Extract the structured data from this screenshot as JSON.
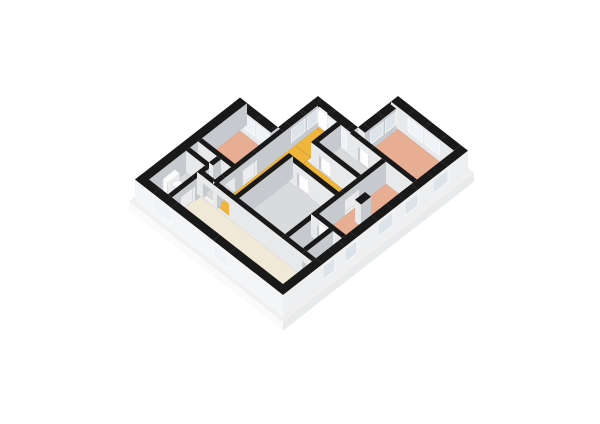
{
  "scene": {
    "proj": {
      "ox": 135,
      "oy": 201.5,
      "sl": 0.78,
      "wallH": 22
    },
    "colors": {
      "bg": "#ffffff",
      "wallTop": "#191919",
      "intS": "#e8e9eb",
      "intE": "#c6c9ce",
      "extS": "#f4f5f6",
      "extE": "#edeff1",
      "sillTop": "#dddfe2",
      "glassS": "#edf3f7",
      "glassE": "#dce4ea",
      "frame": "#ffffff",
      "leafS": "#fdfdfe",
      "leafE": "#ececee",
      "leafTop": "#f6f6f7",
      "plinthTop": "#f0f0f1",
      "plinthS": "#fafafb",
      "plinthE": "#e8eaec",
      "salmon": "#e7ae93",
      "yellow": "#f0b53c",
      "cream": "#f0e9d8",
      "gray": "#d8dadc",
      "bath": "#c3cfda",
      "toiletTop": "#fbfbfc",
      "toiletBody": "#e7e9eb",
      "floorEdge": "rgba(0,0,0,0.10)"
    },
    "plinth": {
      "top": [
        [
          -3,
          -3
        ],
        [
          151,
          -3
        ],
        [
          151,
          188
        ],
        [
          75,
          188
        ],
        [
          75,
          148
        ],
        [
          35,
          148
        ],
        [
          35,
          108
        ],
        [
          -3,
          108
        ]
      ],
      "h": 9
    },
    "floors": [
      {
        "name": "living-room",
        "r": [
          26,
          7,
          141,
          36
        ],
        "c": "cream"
      },
      {
        "name": "wc",
        "r": [
          7,
          7,
          26,
          44
        ],
        "c": "gray"
      },
      {
        "name": "corridor-west",
        "r": [
          7,
          44,
          40,
          56
        ],
        "c": "gray"
      },
      {
        "name": "storage",
        "r": [
          30,
          40,
          44,
          56
        ],
        "c": "gray"
      },
      {
        "name": "bedroom-top-left",
        "r": [
          7,
          60,
          40,
          98
        ],
        "c": "salmon"
      },
      {
        "name": "hall-main",
        "r": [
          44,
          38,
          60,
          116
        ],
        "c": "yellow"
      },
      {
        "name": "hall-entry",
        "r": [
          44,
          116,
          64,
          141
        ],
        "c": "yellow"
      },
      {
        "name": "hall-threshold",
        "r": [
          42,
          138,
          54,
          145
        ],
        "c": "yellow"
      },
      {
        "name": "corridor-east",
        "r": [
          60,
          94,
          110,
          112
        ],
        "c": "yellow"
      },
      {
        "name": "room-middle-south",
        "r": [
          64,
          42,
          110,
          90
        ],
        "c": "gray"
      },
      {
        "name": "room-middle-north",
        "r": [
          68,
          116,
          110,
          137
        ],
        "c": "gray"
      },
      {
        "name": "bathroom",
        "r": [
          114,
          42,
          128,
          66
        ],
        "c": "bath"
      },
      {
        "name": "closet",
        "r": [
          132,
          42,
          141,
          66
        ],
        "c": "gray"
      },
      {
        "name": "bedroom-bottom-right",
        "r": [
          114,
          70,
          141,
          137
        ],
        "c": "salmon"
      },
      {
        "name": "bedroom-top-right",
        "r": [
          85,
          141,
          141,
          178
        ],
        "c": "salmon"
      }
    ],
    "walls": [
      {
        "r": [
          0,
          0,
          7,
          105
        ],
        "t": "s"
      },
      {
        "r": [
          0,
          98,
          10,
          105
        ],
        "t": "s"
      },
      {
        "r": [
          10,
          98,
          22,
          105
        ],
        "t": "w"
      },
      {
        "r": [
          22,
          98,
          24,
          105
        ],
        "t": "s"
      },
      {
        "r": [
          24,
          98,
          36,
          105
        ],
        "t": "w"
      },
      {
        "r": [
          36,
          98,
          38,
          105
        ],
        "t": "s"
      },
      {
        "r": [
          38,
          105,
          44,
          112
        ],
        "t": "s"
      },
      {
        "r": [
          38,
          112,
          44,
          126
        ],
        "t": "w"
      },
      {
        "r": [
          38,
          126,
          44,
          128
        ],
        "t": "s"
      },
      {
        "r": [
          38,
          128,
          44,
          139
        ],
        "t": "w"
      },
      {
        "r": [
          38,
          139,
          44,
          141
        ],
        "t": "s"
      },
      {
        "r": [
          38,
          138,
          42,
          145
        ],
        "t": "s"
      },
      {
        "r": [
          42,
          138,
          54,
          145
        ],
        "t": "h"
      },
      {
        "r": [
          43,
          140,
          53,
          141.5
        ],
        "t": "leaf"
      },
      {
        "r": [
          54,
          138,
          56,
          145
        ],
        "t": "s"
      },
      {
        "r": [
          56,
          138,
          74,
          145
        ],
        "t": "wt"
      },
      {
        "r": [
          74,
          138,
          78,
          145
        ],
        "t": "s"
      },
      {
        "r": [
          78,
          145,
          85,
          150
        ],
        "t": "s"
      },
      {
        "r": [
          78,
          150,
          85,
          163
        ],
        "t": "w"
      },
      {
        "r": [
          78,
          163,
          85,
          165
        ],
        "t": "s"
      },
      {
        "r": [
          78,
          165,
          85,
          176
        ],
        "t": "w"
      },
      {
        "r": [
          78,
          176,
          85,
          178
        ],
        "t": "s"
      },
      {
        "r": [
          78,
          178,
          95,
          185
        ],
        "t": "s"
      },
      {
        "r": [
          95,
          178,
          110,
          185
        ],
        "t": "w"
      },
      {
        "r": [
          110,
          178,
          112,
          185
        ],
        "t": "s"
      },
      {
        "r": [
          112,
          178,
          127,
          185
        ],
        "t": "w"
      },
      {
        "r": [
          127,
          178,
          141,
          185
        ],
        "t": "s"
      },
      {
        "r": [
          141,
          0,
          148,
          40
        ],
        "t": "s",
        "ce": "extE",
        "cs": "extS"
      },
      {
        "r": [
          141,
          40,
          148,
          52
        ],
        "t": "w",
        "ce": "extE"
      },
      {
        "r": [
          141,
          52,
          148,
          62
        ],
        "t": "s",
        "ce": "extE"
      },
      {
        "r": [
          141,
          62,
          148,
          74
        ],
        "t": "w",
        "ce": "extE"
      },
      {
        "r": [
          141,
          74,
          148,
          95
        ],
        "t": "s",
        "ce": "extE"
      },
      {
        "r": [
          141,
          95,
          148,
          110
        ],
        "t": "w",
        "ce": "extE"
      },
      {
        "r": [
          141,
          110,
          148,
          122
        ],
        "t": "s",
        "ce": "extE"
      },
      {
        "r": [
          141,
          122,
          148,
          135
        ],
        "t": "w",
        "ce": "extE"
      },
      {
        "r": [
          141,
          135,
          148,
          150
        ],
        "t": "s",
        "ce": "extE"
      },
      {
        "r": [
          141,
          150,
          148,
          165
        ],
        "t": "w",
        "ce": "extE"
      },
      {
        "r": [
          141,
          165,
          148,
          185
        ],
        "t": "s",
        "ce": "extE"
      },
      {
        "r": [
          0,
          0,
          18,
          7
        ],
        "t": "s",
        "cs": "extS"
      },
      {
        "r": [
          18,
          0,
          36,
          7
        ],
        "t": "w",
        "cs": "extS"
      },
      {
        "r": [
          36,
          0,
          78,
          7
        ],
        "t": "s",
        "cs": "extS"
      },
      {
        "r": [
          78,
          0,
          94,
          7
        ],
        "t": "w",
        "cs": "extS"
      },
      {
        "r": [
          94,
          0,
          148,
          7
        ],
        "t": "s",
        "cs": "extS"
      },
      {
        "r": [
          40,
          38,
          44,
          46
        ],
        "t": "s"
      },
      {
        "r": [
          40,
          46,
          44,
          56
        ],
        "t": "h"
      },
      {
        "r": [
          40,
          56,
          44,
          64
        ],
        "t": "s"
      },
      {
        "r": [
          40,
          64,
          44,
          78
        ],
        "t": "h"
      },
      {
        "r": [
          41,
          65,
          42.5,
          77
        ],
        "t": "leaf"
      },
      {
        "r": [
          40,
          78,
          44,
          105
        ],
        "t": "s"
      },
      {
        "r": [
          7,
          56,
          44,
          60
        ],
        "t": "s"
      },
      {
        "r": [
          7,
          44,
          30,
          48
        ],
        "t": "s"
      },
      {
        "r": [
          26,
          7,
          30,
          16
        ],
        "t": "s"
      },
      {
        "r": [
          26,
          16,
          30,
          30
        ],
        "t": "h"
      },
      {
        "r": [
          27,
          17,
          28.5,
          29
        ],
        "t": "leaf"
      },
      {
        "r": [
          26,
          30,
          30,
          44
        ],
        "t": "s"
      },
      {
        "r": [
          26,
          48,
          30,
          56
        ],
        "t": "s"
      },
      {
        "r": [
          26,
          36,
          32,
          40
        ],
        "t": "s"
      },
      {
        "r": [
          32,
          36,
          42,
          40
        ],
        "t": "h"
      },
      {
        "r": [
          42,
          36,
          46,
          40
        ],
        "t": "s"
      },
      {
        "r": [
          46,
          36,
          58,
          40
        ],
        "t": "h"
      },
      {
        "r": [
          58,
          36,
          110,
          40
        ],
        "t": "s"
      },
      {
        "r": [
          110,
          36,
          131,
          40
        ],
        "t": "s"
      },
      {
        "r": [
          131,
          36,
          139,
          40
        ],
        "t": "h"
      },
      {
        "r": [
          139,
          36,
          141,
          40
        ],
        "t": "s"
      },
      {
        "r": [
          60,
          38,
          64,
          94
        ],
        "t": "s"
      },
      {
        "r": [
          64,
          90,
          72,
          94
        ],
        "t": "s"
      },
      {
        "r": [
          72,
          90,
          84,
          94
        ],
        "t": "h"
      },
      {
        "r": [
          73,
          91,
          83,
          92.5
        ],
        "t": "leaf"
      },
      {
        "r": [
          84,
          90,
          110,
          94
        ],
        "t": "s"
      },
      {
        "r": [
          64,
          112,
          72,
          116
        ],
        "t": "s"
      },
      {
        "r": [
          72,
          112,
          84,
          116
        ],
        "t": "h"
      },
      {
        "r": [
          73,
          113,
          83,
          114.5
        ],
        "t": "leaf"
      },
      {
        "r": [
          84,
          112,
          110,
          116
        ],
        "t": "s"
      },
      {
        "r": [
          64,
          116,
          68,
          138
        ],
        "t": "s"
      },
      {
        "r": [
          110,
          40,
          114,
          96
        ],
        "t": "s"
      },
      {
        "r": [
          110,
          96,
          114,
          110
        ],
        "t": "h"
      },
      {
        "r": [
          110.5,
          97,
          112,
          109
        ],
        "t": "leaf"
      },
      {
        "r": [
          110,
          110,
          114,
          137
        ],
        "t": "s"
      },
      {
        "r": [
          110,
          66,
          116,
          70
        ],
        "t": "s"
      },
      {
        "r": [
          116,
          66,
          126,
          70
        ],
        "t": "h"
      },
      {
        "r": [
          117,
          66.8,
          126,
          68.2
        ],
        "t": "leaf"
      },
      {
        "r": [
          126,
          66,
          141,
          70
        ],
        "t": "s"
      },
      {
        "r": [
          128,
          40,
          132,
          66
        ],
        "t": "s"
      },
      {
        "r": [
          123,
          97,
          129,
          107
        ],
        "t": "s"
      },
      {
        "r": [
          78,
          137,
          86,
          141
        ],
        "t": "s"
      },
      {
        "r": [
          86,
          137,
          98,
          141
        ],
        "t": "h"
      },
      {
        "r": [
          87,
          137.8,
          96,
          139.2
        ],
        "t": "leaf"
      },
      {
        "r": [
          98,
          137,
          141,
          141
        ],
        "t": "s"
      }
    ],
    "toilet": {
      "tank": [
        8,
        20,
        12.5,
        32
      ],
      "tankH": 13,
      "bowl": {
        "a": 16.5,
        "b": 26
      }
    }
  }
}
